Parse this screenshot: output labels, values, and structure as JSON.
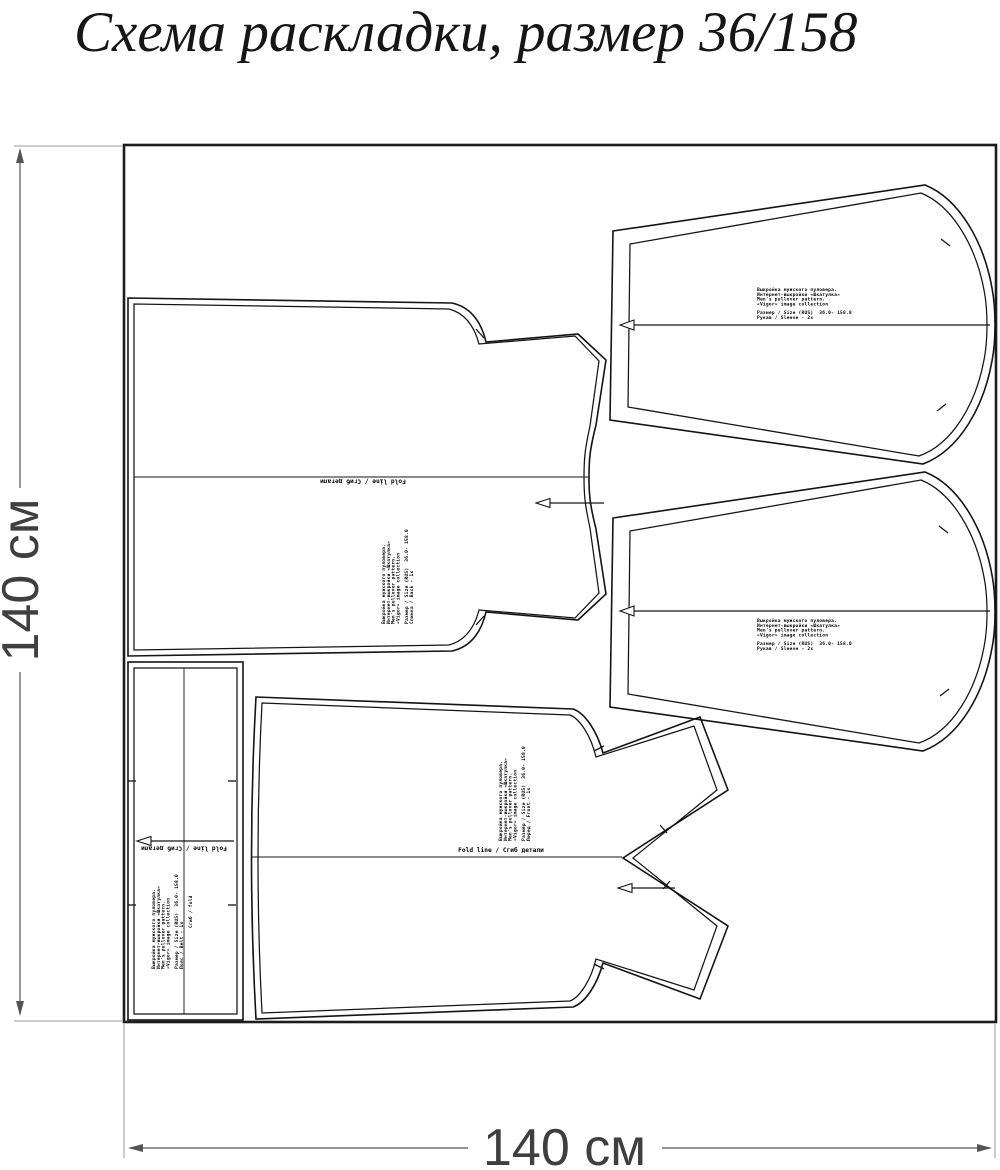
{
  "title": "Схема раскладки, размер 36/158",
  "dimensions": {
    "height_label": "140 см",
    "width_label": "140 см"
  },
  "labels": {
    "fold_line": "Fold line / Сгиб детали",
    "band_fold": "Сгиб / fold"
  },
  "pattern_info": {
    "header_lines": [
      "Выкройка мужского пуловера.",
      "Интернет-выкройки «Шкатулка»",
      "Men's pullover pattern.",
      "«Vigor» image collection"
    ],
    "size_line": "Размер / Size (RUS)  36.0- 158.0"
  },
  "pieces": {
    "sleeve_top": {
      "label": "Рукав / Sleeve - 2x"
    },
    "sleeve_bottom": {
      "label": "Рукав / Sleeve - 2x"
    },
    "back": {
      "label": "Спинка / Back - 1x"
    },
    "front": {
      "label": "Перед / Front - 1x"
    },
    "band": {
      "label": "Пояс / Belt - 1x"
    }
  },
  "colors": {
    "outline": "#141414",
    "dimension": "#555555",
    "label_text": "#3f3f3f",
    "background": "#ffffff"
  }
}
